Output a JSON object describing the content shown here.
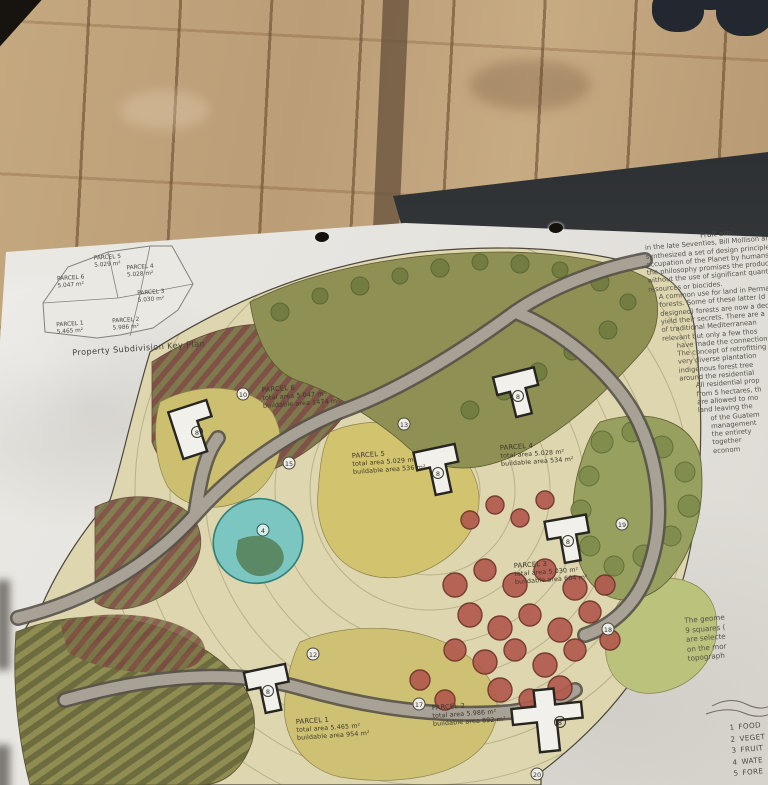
{
  "key_plan": {
    "title": "Property Subdivision Key Plan",
    "parcels": [
      {
        "name": "PARCEL 5",
        "area": "5.029 m²"
      },
      {
        "name": "PARCEL 4",
        "area": "5.028 m²"
      },
      {
        "name": "PARCEL 6",
        "area": "5.047 m²"
      },
      {
        "name": "PARCEL 3",
        "area": "5.030 m²"
      },
      {
        "name": "PARCEL 1",
        "area": "5.465 m²"
      },
      {
        "name": "PARCEL 2",
        "area": "5.986 m²"
      }
    ]
  },
  "site_plan": {
    "parcel_labels": [
      {
        "name": "PARCEL 6",
        "line2": "total area 5.047 m²",
        "line3": "buildable area 1474 m²"
      },
      {
        "name": "PARCEL 5",
        "line2": "total area 5.029 m²",
        "line3": "buildable area 536 m²"
      },
      {
        "name": "PARCEL 4",
        "line2": "total area 5.028 m²",
        "line3": "buildable area 534 m²"
      },
      {
        "name": "PARCEL 3",
        "line2": "total area 5.030 m²",
        "line3": "buildable area 604 m²"
      },
      {
        "name": "PARCEL 1",
        "line2": "total area 5.465 m²",
        "line3": "buildable area 954 m²"
      },
      {
        "name": "PARCEL 2",
        "line2": "total area 5.986 m²",
        "line3": "buildable area 892 m²"
      }
    ],
    "house_marker": "8",
    "pond_marker": "4",
    "ref_markers": [
      "10",
      "13",
      "15",
      "19",
      "12",
      "17",
      "18",
      "20"
    ]
  },
  "right_text": {
    "heading": "Fruit arb",
    "lines": [
      "in the late Seventies, Bill Mollison and",
      "synthesized a set of design principles t",
      "occupation of the Planet by humans know",
      "the philosophy promises the production",
      "without the use of significant quantit",
      "resources or biocides.",
      "A common use for land in Permacu",
      "forests. Some of these latter (d",
      "designed) forests are now a dec",
      "yield their secrets. There are a",
      "of traditional Mediterranean",
      "relevant but only a few thos",
      "have made the connections",
      "The concept of retrofitting",
      "very diverse plantation",
      "indigenous forest tree",
      "around the residential",
      "All residential prop",
      "from 5 hectares, th",
      "are allowed to mo",
      "land leaving the",
      "of the Guatem",
      "management",
      "the entirety",
      "together",
      "econom"
    ]
  },
  "notes_text": {
    "lines": [
      "The geome",
      "9 squares (",
      "are selecte",
      "on the mor",
      "topograph"
    ]
  },
  "legend": {
    "items": [
      {
        "num": "1",
        "label": "FOOD"
      },
      {
        "num": "2",
        "label": "VEGET"
      },
      {
        "num": "3",
        "label": "FRUIT"
      },
      {
        "num": "4",
        "label": "WATE"
      },
      {
        "num": "5",
        "label": "FORE"
      }
    ]
  },
  "colors": {
    "pond": "#7cc6c2",
    "fruit_tree": "#b25a4e",
    "forest": "#8f9054",
    "road": "#a8a196",
    "vine_rows": "#7c4a41",
    "paper": "#e8e6e1"
  }
}
